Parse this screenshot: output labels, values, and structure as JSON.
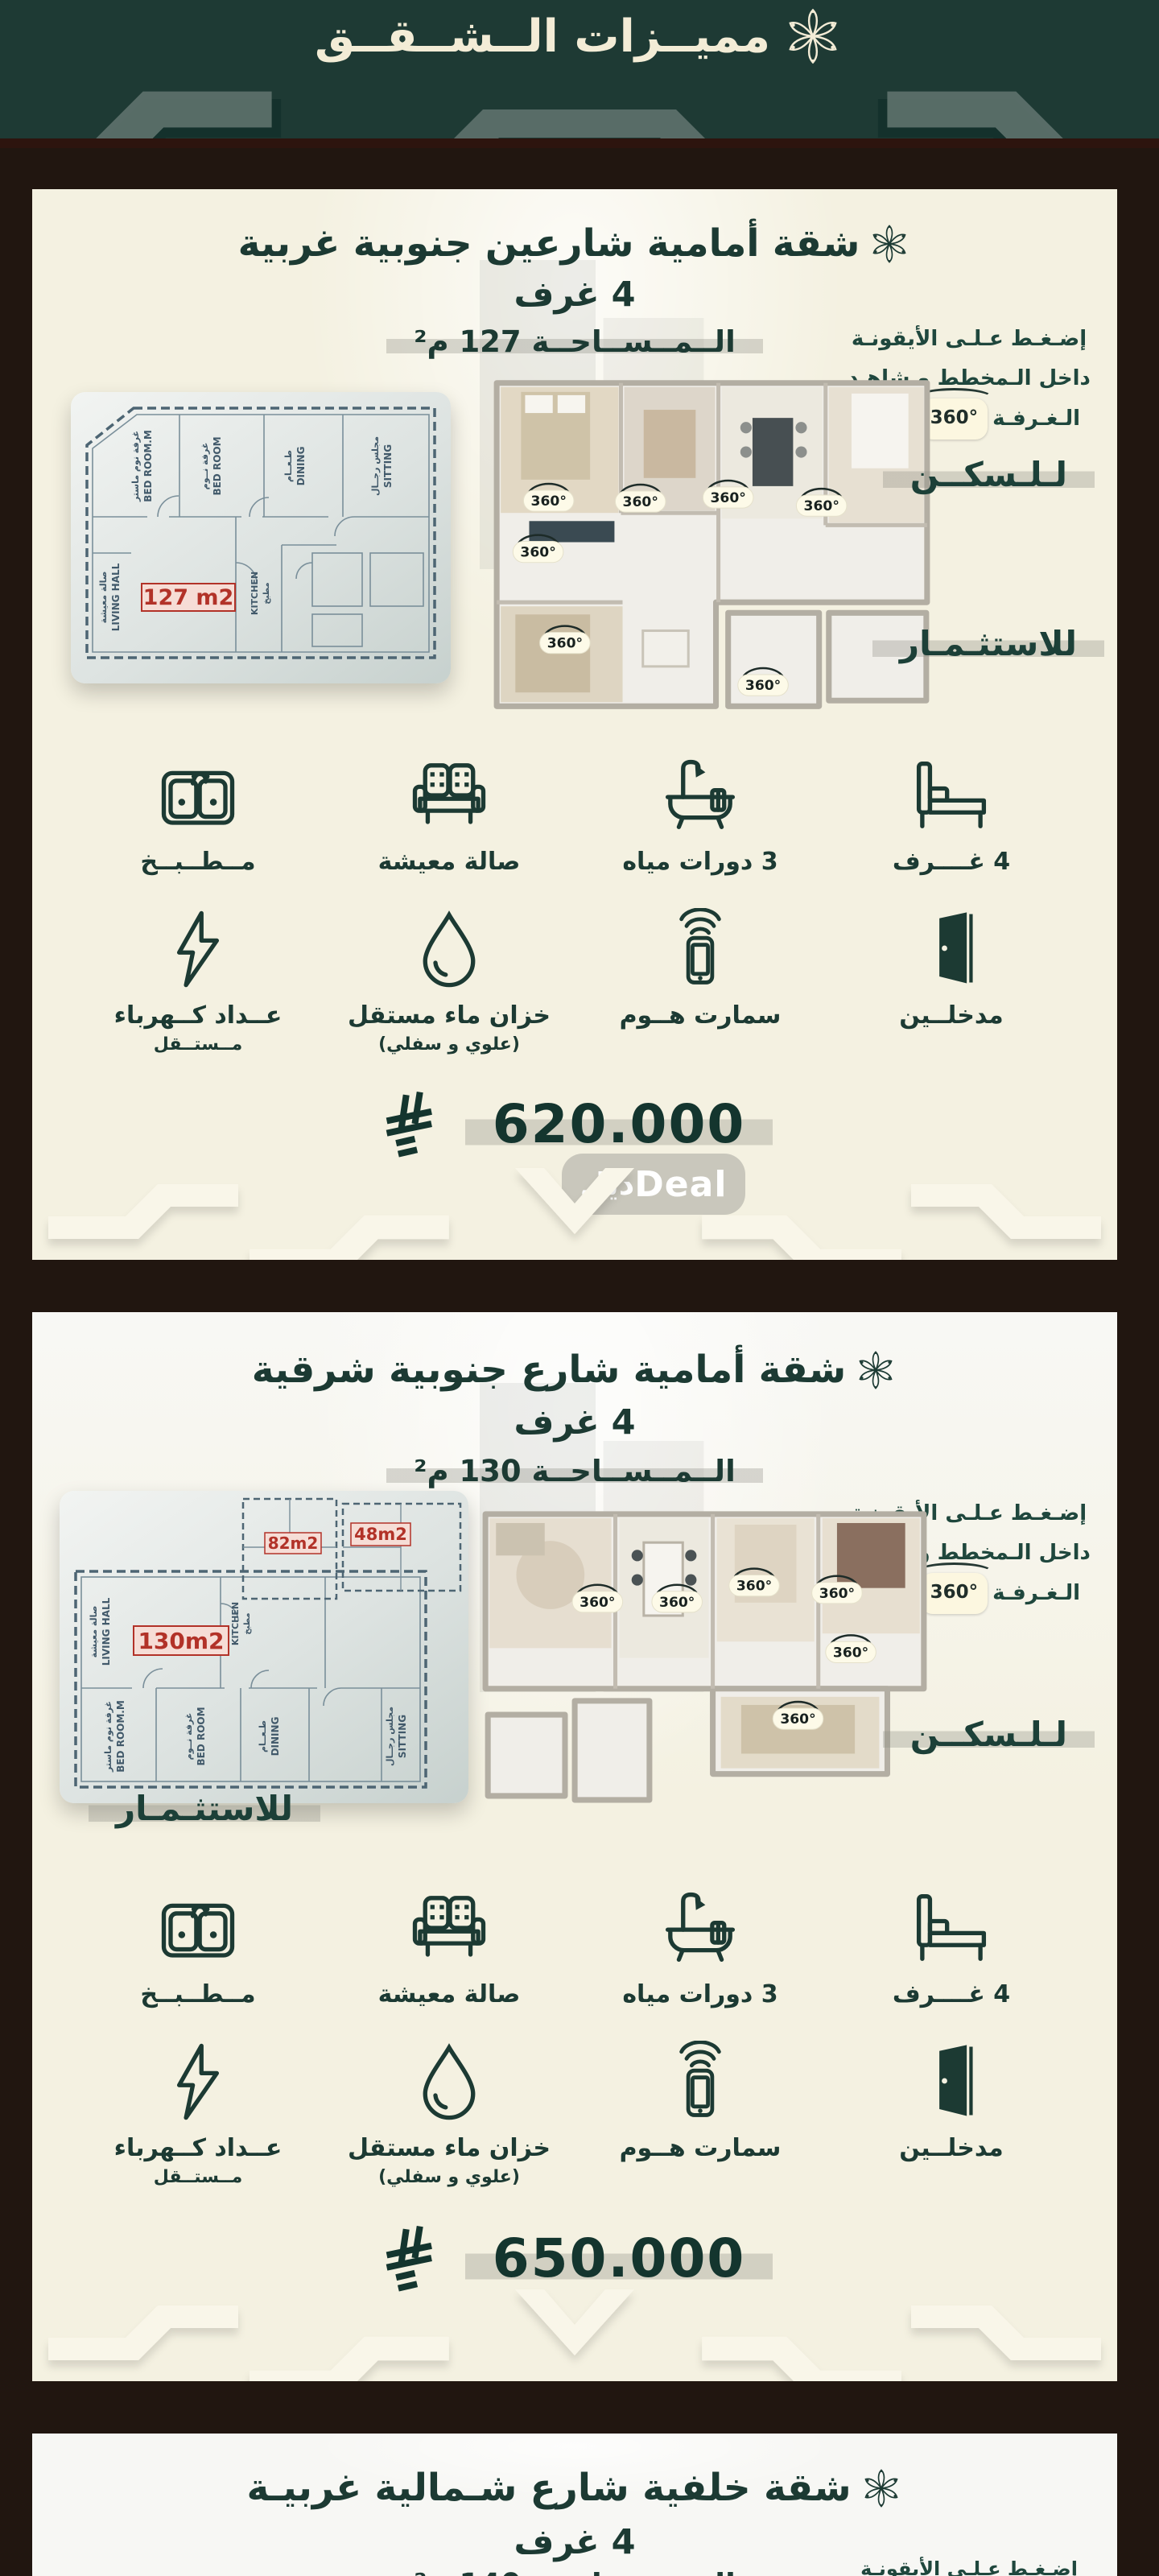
{
  "header": {
    "title": "مميــزات الــشــقــق"
  },
  "misc": {
    "badge_360": "360°",
    "watermark": {
      "arabic": "ديل",
      "latin": "Deal"
    }
  },
  "instruction": {
    "line1": "إضـغـط عـلـى الأيقونـة",
    "line2": "داخل الـمخطط و شاهـد",
    "line3_pre": "الـغـرفـة",
    "line3_post": "درجـة"
  },
  "labels": {
    "for_living": "لـلـسكــن",
    "for_investment": "للاستثـمـار"
  },
  "features": {
    "row1": [
      {
        "name": "kitchen",
        "label": "مــطــبــخ"
      },
      {
        "name": "living-room",
        "label": "صالة معيشة"
      },
      {
        "name": "bathrooms",
        "label": "3 دورات مياه"
      },
      {
        "name": "bedrooms",
        "label": "4 غــــرف"
      }
    ],
    "row2": [
      {
        "name": "electric-meter",
        "label": "عــداد كــهرباء",
        "sub": "مــستــقل"
      },
      {
        "name": "water-tank",
        "label": "خزان ماء مستقل",
        "sub": "(علوي و سفلي)"
      },
      {
        "name": "smart-home",
        "label": "سمارت هــوم",
        "sub": ""
      },
      {
        "name": "two-entrances",
        "label": "مدخلــين",
        "sub": ""
      }
    ]
  },
  "cards": [
    {
      "title": "شقة أمامية شارعين جنوبية غربية",
      "rooms": "4 غرف",
      "area": "الــمــســاحــة 127 م²",
      "price": "620.000",
      "plan": {
        "area_label": "127 m2",
        "rooms": [
          {
            "ar": "غرفة نوم ماستر",
            "en": "BED ROOM.M"
          },
          {
            "ar": "غرفة نــوم",
            "en": "BED ROOM"
          },
          {
            "ar": "طـعــام",
            "en": "DINING"
          },
          {
            "ar": "مجلس رجــال",
            "en": "SITTING"
          },
          {
            "ar": "صالة معيشة",
            "en": "LIVING HALL"
          },
          {
            "ar": "مطبخ",
            "en": "KITCHEN"
          }
        ]
      }
    },
    {
      "title": "شقة أمامية شارع جنوبية شرقية",
      "rooms": "4 غرف",
      "area": "الــمــســاحــة 130 م²",
      "price": "650.000",
      "plan": {
        "area_label": "130m2",
        "mini_labels": [
          "82m2",
          "48m2"
        ],
        "rooms": [
          {
            "ar": "غرفة نوم ماستر",
            "en": "BED ROOM.M"
          },
          {
            "ar": "غرفة نــوم",
            "en": "BED ROOM"
          },
          {
            "ar": "طـعــام",
            "en": "DINING"
          },
          {
            "ar": "مجلس رجــال",
            "en": "SITTING"
          },
          {
            "ar": "صالة معيشة",
            "en": "LIVING HALL"
          },
          {
            "ar": "مطبخ",
            "en": "KITCHEN"
          }
        ]
      }
    },
    {
      "title": "شقة خلفية شارع شـمالية غربيـة",
      "rooms": "4 غرف",
      "area": "الــمــســاحــة 140 م²"
    }
  ]
}
